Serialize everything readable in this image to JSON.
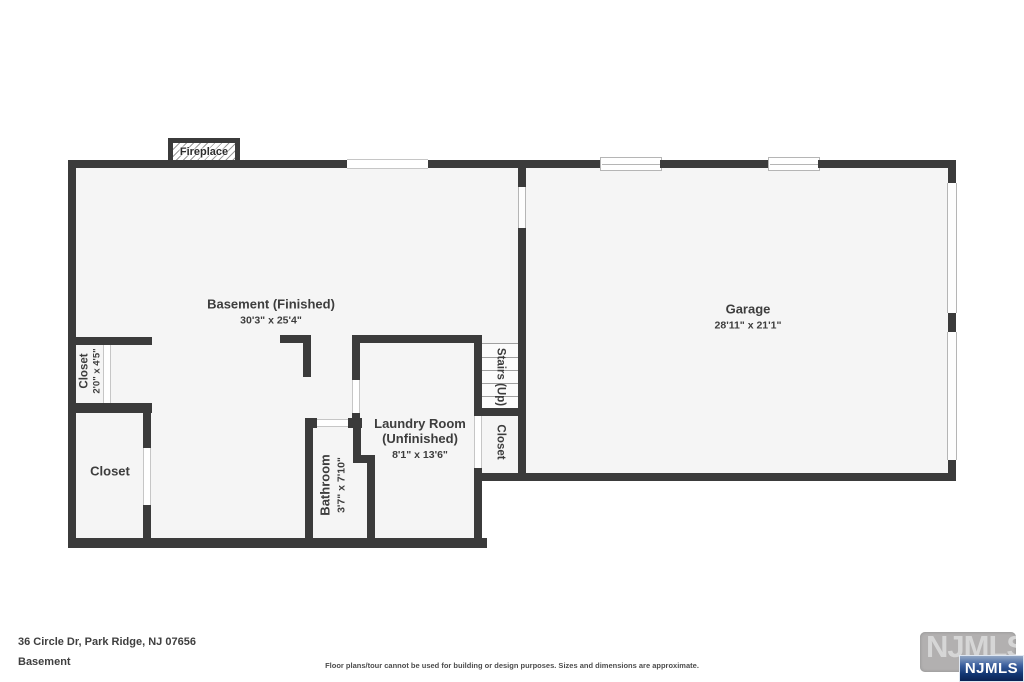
{
  "plan": {
    "fireplace_label": "Fireplace",
    "rooms": {
      "basement": {
        "name": "Basement (Finished)",
        "dims": "30'3\" x 25'4\""
      },
      "garage": {
        "name": "Garage",
        "dims": "28'11\" x 21'1\""
      },
      "laundry": {
        "name_line1": "Laundry Room",
        "name_line2": "(Unfinished)",
        "dims": "8'1\" x 13'6\""
      },
      "bathroom": {
        "name": "Bathroom",
        "dims": "3'7\" x 7'10\""
      },
      "closet_small": {
        "name": "Closet",
        "dims": "2'0\" x 4'5\""
      },
      "closet_large": {
        "name": "Closet"
      },
      "closet_stairs": {
        "name": "Closet"
      },
      "stairs": {
        "name": "Stairs (Up)"
      }
    }
  },
  "footer": {
    "address": "36 Circle Dr, Park Ridge, NJ 07656",
    "level": "Basement",
    "disclaimer": "Floor plans/tour cannot be used for building or design purposes. Sizes and dimensions are approximate."
  },
  "logo": {
    "watermark_text": "NJMLS",
    "badge_text": "NJMLS"
  },
  "colors": {
    "wall": "#3b3b3b",
    "floor": "#f5f5f5",
    "badge_blue": "#123672"
  }
}
